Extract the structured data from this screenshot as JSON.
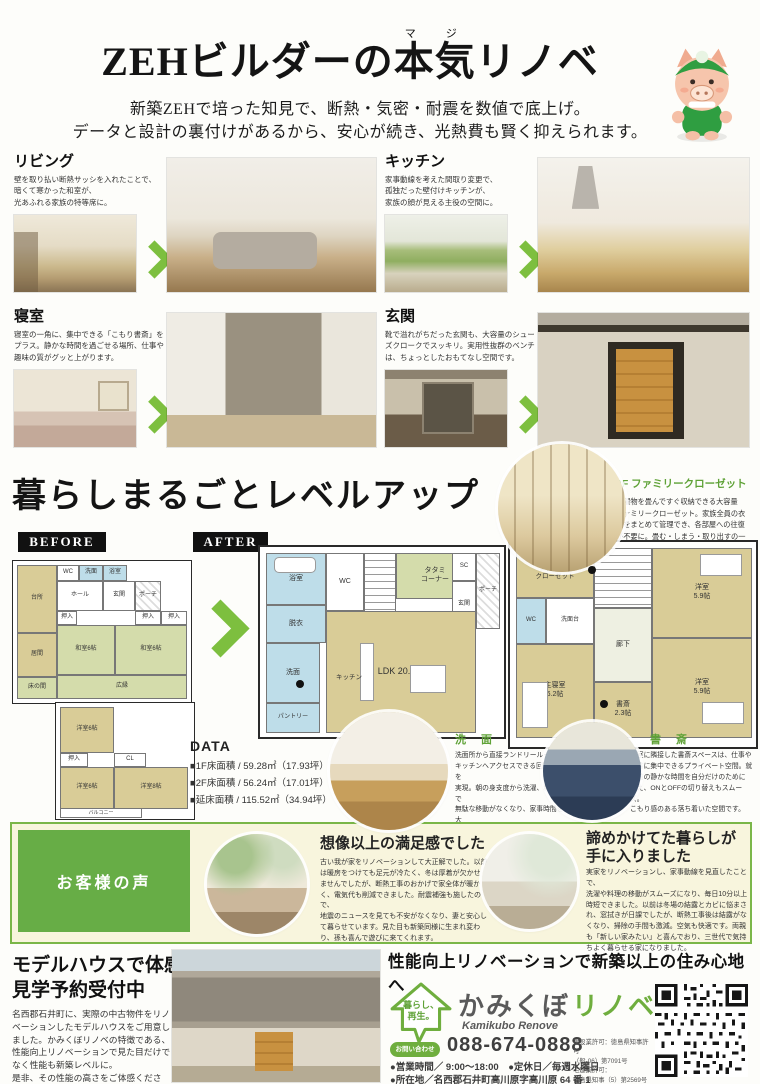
{
  "header": {
    "furigana": "マジ",
    "title_pre": "ZEHビルダーの",
    "title_ruby": "本気",
    "title_post": "リノベ",
    "subtitle1": "新築ZEHで培った知見で、断熱・気密・耐震を数値で底上げ。",
    "subtitle2": "データと設計の裏付けがあるから、安心が続き、光熱費も賢く抑えられます。"
  },
  "features": [
    {
      "title": "リビング",
      "desc": "壁を取り払い断熱サッシを入れたことで、\n暗くて寒かった和室が、\n光あふれる家族の特等席に。"
    },
    {
      "title": "キッチン",
      "desc": "家事動線を考えた間取り変更で、\n孤独だった壁付けキッチンが、\n家族の顔が見える主役の空間に。"
    },
    {
      "title": "寝室",
      "desc": "寝室の一角に、集中できる「こもり書斎」を\nプラス。静かな時間を過ごせる場所、仕事や\n趣味の質がグッと上がります。"
    },
    {
      "title": "玄関",
      "desc": "靴で溢れがちだった玄関も、大容量のシュー\nズクロークでスッキリ。実用性抜群のベンチ\nは、ちょっとしたおもてなし空間です。"
    }
  ],
  "levelup": {
    "heading": "暮らしまるごとレベルアップ"
  },
  "closet": {
    "heading": "2F ファミリークローゼット",
    "body": "洗濯物を畳んですぐ収納できる大容量\nファミリークローゼット。家族全員の衣\n類をまとめて管理でき、各部屋への往復\nが不要に。畳む・しまう・取り出すの一\n連の動作がワンフロアで完結します。"
  },
  "plans": {
    "before_label": "BEFORE",
    "after_label": "AFTER",
    "after1f": {
      "bath": "浴室",
      "datsui": "脱衣",
      "wc": "WC",
      "tatami": "タタミ\nコーナー",
      "sc": "SC",
      "porch": "ポーチ",
      "genkan": "玄関",
      "hall": "ホール",
      "ldk": "LDK 20.2帖",
      "kitchen": "キッチン",
      "senmen": "洗面",
      "pantry": "パントリー"
    },
    "after2f": {
      "fc": "ファミリー\nクローゼット",
      "wc": "WC",
      "vanity": "洗面台",
      "hall": "廊下",
      "bed1": "洋室\n5.9帖",
      "bed2": "洋室\n5.9帖",
      "main": "主寝室\n6.2帖",
      "study": "書斎\n2.3帖"
    },
    "before1f": {
      "kitchen": "台所",
      "wc": "WC",
      "wash": "洗面",
      "bath": "浴室",
      "hall": "ホール",
      "genkan": "玄関",
      "porch": "ポーチ",
      "ima": "居間",
      "oshi1": "押入",
      "oshi2": "押入",
      "oshi3": "押入",
      "washitsu1": "和室6帖",
      "washitsu2": "和室6帖",
      "toko": "床の間",
      "hiroen": "広縁"
    },
    "before2f": {
      "yo1": "洋室6帖",
      "oshi": "押入",
      "cl": "CL",
      "yo2": "洋室6帖",
      "yo3": "洋室8帖",
      "balcony": "バルコニー"
    }
  },
  "data_section": {
    "heading": "DATA",
    "rows": [
      "■1F床面積 / 59.28㎡（17.93坪）",
      "■2F床面積 / 56.24㎡（17.01坪）",
      "■延床面積 / 115.52㎡（34.94坪）"
    ]
  },
  "washroom": {
    "heading": "洗 面",
    "body": "洗面所から直接ランドリールームや\nキッチンへアクセスできる回遊動線を\n実現。朝の身支度から洗濯、料理まで\n無駄な移動がなくなり、家事時間を大\n幅に短縮できる「家事ラク設計」です。"
  },
  "study": {
    "heading": "書 斎",
    "body": "寝室に隣接した書斎スペースは、仕事や\n読書に集中できるプライベート空間。就\n寝前の静かな時間を自分だけのために\n使え、ONとOFFの切り替えもスムーズ。\nこもり感のある落ち着いた空間です。"
  },
  "voice": {
    "label": "お客様の声",
    "t1": {
      "heading": "想像以上の満足感でした",
      "body": "古い我が家をリノベーションして大正解でした。以前\nは暖房をつけても足元が冷たく、冬は厚着が欠かせ\nませんでしたが、断熱工事のおかげで家全体が暖か\nく、電気代も削減できました。耐震補強も施したので、\n地震のニュースを見ても不安がなくなり、妻と安心し\nて暮らせています。見た目も新築同様に生まれ変わ\nり、孫も喜んで遊びに来てくれます。"
    },
    "t2": {
      "heading": "諦めかけてた暮らしが\n手に入りました",
      "body": "実家をリノベーションし、家事動線を見直したことで、\n洗濯や料理の移動がスムーズになり、毎日10分以上\n時短できました。以前は冬場の結露とカビに悩まさ\nれ、窓拭きが日課でしたが、断熱工事後は結露がな\nくなり、掃除の手間も激減。空気も快適です。両親\nも「新しい家みたい」と喜んでおり、三世代で気持\nちよく暮らせる家になりました。"
    }
  },
  "modelhouse": {
    "heading1": "モデルハウスで体感",
    "heading2": "見学予約受付中",
    "body": "名西郡石井町に、実際の中古物件をリノ\nベーションしたモデルハウスをご用意し\nました。かみくぼリノベの特徴である、\n性能向上リノベーションで見た目だけで\nなく性能も新築レベルに。\n是非、その性能の高さをご体感ください。"
  },
  "footer": {
    "catch": "性能向上リノベーションで新築以上の住み心地へ",
    "logo_tag": "暮らし、\n再生。",
    "brand_gray": "かみくぼ",
    "brand_green": "リノベ",
    "brand_en": "Kamikubo Renove",
    "contact_label": "お問い合わせ",
    "phone": "088-674-0888",
    "license": "建設業許可：徳島県知事許可\n（般-06）第7091号\n宅建業許可：\n徳島県知事（5）第2569号",
    "info1": "●営業時間／ 9:00～18:00　●定休日／毎週水曜日",
    "info2": "●所在地／名西郡石井町高川原字高川原 64 番 1"
  },
  "colors": {
    "accent_green": "#6fae3e",
    "arrow_green": "#7dbf3f",
    "voice_band_bg": "#f8f5dd",
    "plan_tan": "#d9cc97",
    "plan_blue": "#bedde9",
    "plan_tatami_green": "#d4dcab"
  }
}
